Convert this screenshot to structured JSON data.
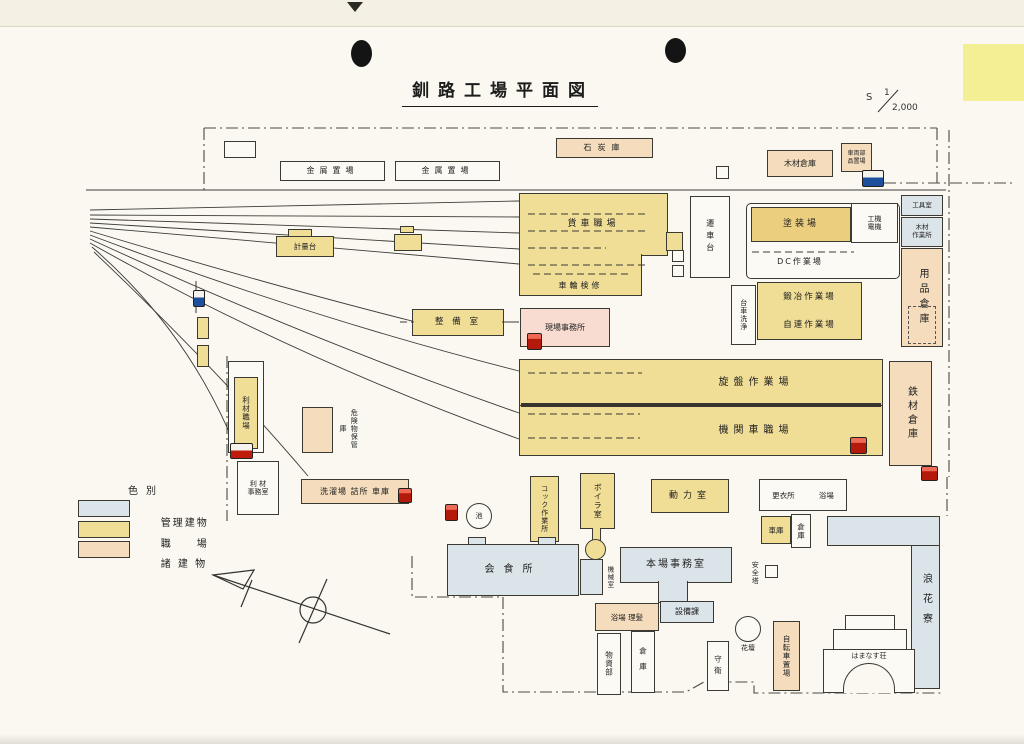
{
  "page": {
    "title": "釧路工場平面図"
  },
  "scale": {
    "prefix": "S",
    "num": "1",
    "den": "2,000"
  },
  "legend": {
    "title": "色別",
    "items": [
      {
        "label": "管理建物",
        "color": "#dbe4e9"
      },
      {
        "label": "職　　場",
        "color": "#f0dd96"
      },
      {
        "label": "諸 建 物",
        "color": "#f4dcbc"
      }
    ]
  },
  "buildings": {
    "coal_shed": "石炭庫",
    "scrap_yard": "金屑置場",
    "metal_yard": "金属置場",
    "wood_warehouse": "木材倉庫",
    "vehicle_parts_1": "車両部",
    "vehicle_parts_2": "品置場",
    "weighbridge": "計量台",
    "freight_car_shop": "貨車職場",
    "wheel_inspection": "車輪検修",
    "traverser": "遷車台",
    "paint_shop": "塗装場",
    "machine_unit": "工機",
    "electric_unit": "電機",
    "dc_shop": "DC作業場",
    "bogie_washing": "台車洗浄",
    "forge_shop": "鍛冶作業場",
    "coupler_shop": "自連作業場",
    "tool_room": "工具室",
    "wood_workshop_1": "木材",
    "wood_workshop_2": "作業所",
    "supplies_warehouse": "用品倉庫",
    "maintenance_room": "整 備 室",
    "site_office": "現場事務所",
    "lathe_shop": "旋盤作業場",
    "locomotive_shop": "機関車職場",
    "steel_warehouse": "鉄材倉庫",
    "salvage_shop": "利材職場",
    "hazmat_storage": "危険物保管庫",
    "salvage_office_1": "利 材",
    "salvage_office_2": "事務室",
    "laundry_row": "洗濯場 詰所 車庫",
    "pond": "池",
    "cock_workshop": "コック作業所",
    "boiler_room": "ボイラ室",
    "power_room": "動力室",
    "dining_hall": "会食所",
    "machine_room": "機械室",
    "main_office": "本場事務室",
    "facilities_sec": "設備課",
    "bath_barber": "浴場 理髪",
    "goods_dept": "物資部",
    "warehouse_a": "倉庫",
    "guard_post": "守衛",
    "flower_bed": "花壇",
    "safety_tower": "安全塔",
    "changing_room": "更衣所",
    "bath_house": "浴場",
    "garage": "車庫",
    "warehouse_b": "倉庫",
    "bicycle_parking": "自転車置場",
    "naniwa_dorm": "浪花寮",
    "hamanasu_lodge": "はまなす荘"
  }
}
